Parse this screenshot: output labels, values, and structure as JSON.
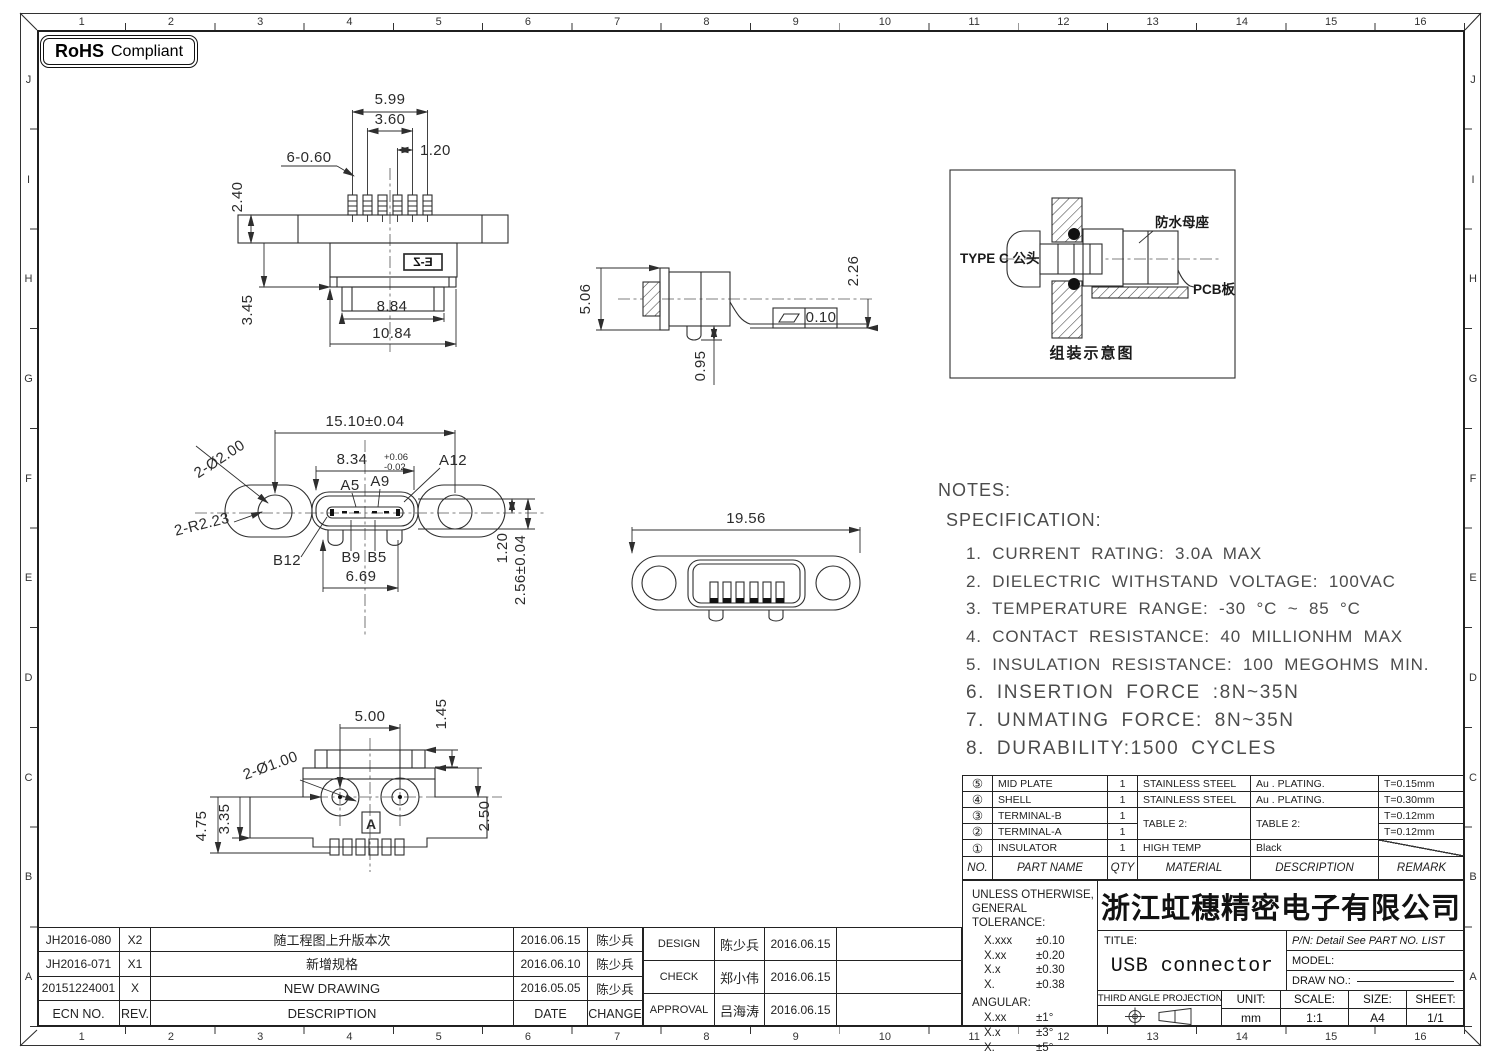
{
  "rohs": {
    "brand": "RoHS",
    "text": "Compliant"
  },
  "grid": {
    "cols": [
      "1",
      "2",
      "3",
      "4",
      "5",
      "6",
      "7",
      "8",
      "9",
      "10",
      "11",
      "12",
      "13",
      "14",
      "15",
      "16"
    ],
    "rows": [
      "J",
      "I",
      "H",
      "G",
      "F",
      "E",
      "D",
      "C",
      "B",
      "A"
    ]
  },
  "views": {
    "top": {
      "pin_span": "5.99",
      "inner_span": "3.60",
      "pitch": "1.20",
      "pin_width": "6-0.60",
      "bar_height": "2.40",
      "mid_height": "3.45",
      "cap_width": "8.84",
      "base_width": "10.84",
      "logo": "E-Z"
    },
    "side": {
      "height": "5.06",
      "post": "0.95",
      "tail_height": "2.26",
      "flatness": "0.10"
    },
    "assembly": {
      "plug_label": "TYPE C 公头",
      "socket_label": "防水母座",
      "pcb_label": "PCB板",
      "caption": "组装示意图"
    },
    "front": {
      "width": "15.10±0.04",
      "opening": "8.34",
      "tol_plus": "+0.06",
      "tol_minus": "-0.02",
      "pin_a12": "A12",
      "pin_a5": "A5",
      "pin_a9": "A9",
      "holes": "2-Ø2.00",
      "radius": "2-R2.23",
      "pin_b12": "B12",
      "pin_b9": "B9",
      "pin_b5": "B5",
      "tongue_span": "6.69",
      "tongue_offset": "1.20",
      "depth": "2.56±0.04"
    },
    "back": {
      "width": "19.56"
    },
    "bottom": {
      "boss_span": "5.00",
      "step": "1.45",
      "holes": "2-Ø1.00",
      "height_total": "4.75",
      "height_body": "3.35",
      "height_right": "2.50",
      "section": "A"
    }
  },
  "notes": {
    "heading": "NOTES:",
    "subheading": "SPECIFICATION:",
    "items": [
      "1. CURRENT RATING: 3.0A MAX",
      "2. DIELECTRIC WITHSTAND VOLTAGE: 100VAC",
      "3. TEMPERATURE RANGE: -30 °C ~ 85 °C",
      "4. CONTACT RESISTANCE: 40 MILLIONHM MAX",
      "5. INSULATION RESISTANCE: 100 MEGOHMS MIN.",
      "6. INSERTION FORCE :8N~35N",
      "7. UNMATING FORCE: 8N~35N",
      "8. DURABILITY:1500 CYCLES"
    ]
  },
  "parts_table": {
    "headers": [
      "NO.",
      "PART NAME",
      "QTY",
      "MATERIAL",
      "DESCRIPTION",
      "REMARK"
    ],
    "rows": [
      {
        "no": "⑤",
        "name": "MID PLATE",
        "qty": "1",
        "material": "STAINLESS STEEL",
        "description": "Au . PLATING.",
        "remark": "T=0.15mm"
      },
      {
        "no": "④",
        "name": "SHELL",
        "qty": "1",
        "material": "STAINLESS STEEL",
        "description": "Au . PLATING.",
        "remark": "T=0.30mm"
      },
      {
        "no": "③",
        "name": "TERMINAL-B",
        "qty": "1",
        "material": "TABLE 2:",
        "description": "TABLE 2:",
        "remark": "T=0.12mm"
      },
      {
        "no": "②",
        "name": "TERMINAL-A",
        "qty": "1",
        "material": "",
        "description": "",
        "remark": "T=0.12mm"
      },
      {
        "no": "①",
        "name": "INSULATOR",
        "qty": "1",
        "material": "HIGH TEMP",
        "description": "Black",
        "remark": ""
      }
    ]
  },
  "tolerance": {
    "line1": "UNLESS OTHERWISE,",
    "line2": "GENERAL TOLERANCE:",
    "rows": [
      [
        "X.xxx",
        "±0.10"
      ],
      [
        "X.xx",
        "±0.20"
      ],
      [
        "X.x",
        "±0.30"
      ],
      [
        "X.",
        "±0.38"
      ]
    ],
    "angular_label": "ANGULAR:",
    "angular_rows": [
      [
        "X.xx",
        "±1°"
      ],
      [
        "X.x",
        "±3°"
      ],
      [
        "X.",
        "±5°"
      ]
    ]
  },
  "title_block": {
    "company": "浙江虹穗精密电子有限公司",
    "title_label": "TITLE:",
    "title": "USB connector",
    "pn": "P/N: Detail See PART NO. LIST",
    "model_label": "MODEL:",
    "draw_no_label": "DRAW NO.:",
    "projection_label": "THIRD ANGLE PROJECTION",
    "unit_label": "UNIT:",
    "unit": "mm",
    "scale_label": "SCALE:",
    "scale": "1:1",
    "size_label": "SIZE:",
    "size": "A4",
    "sheet_label": "SHEET:",
    "sheet": "1/1"
  },
  "revision_table": {
    "headers": [
      "ECN NO.",
      "REV.",
      "DESCRIPTION",
      "DATE",
      "CHANGE"
    ],
    "rows": [
      {
        "ecn": "JH2016-080",
        "rev": "X2",
        "description": "随工程图上升版本次",
        "date": "2016.06.15",
        "change": "陈少兵"
      },
      {
        "ecn": "JH2016-071",
        "rev": "X1",
        "description": "新增规格",
        "date": "2016.06.10",
        "change": "陈少兵"
      },
      {
        "ecn": "20151224001",
        "rev": "X",
        "description": "NEW DRAWING",
        "date": "2016.05.05",
        "change": "陈少兵"
      }
    ]
  },
  "approval_table": {
    "rows": [
      {
        "role": "DESIGN",
        "name": "陈少兵",
        "date": "2016.06.15"
      },
      {
        "role": "CHECK",
        "name": "郑小伟",
        "date": "2016.06.15"
      },
      {
        "role": "APPROVAL",
        "name": "吕海涛",
        "date": "2016.06.15"
      }
    ]
  }
}
